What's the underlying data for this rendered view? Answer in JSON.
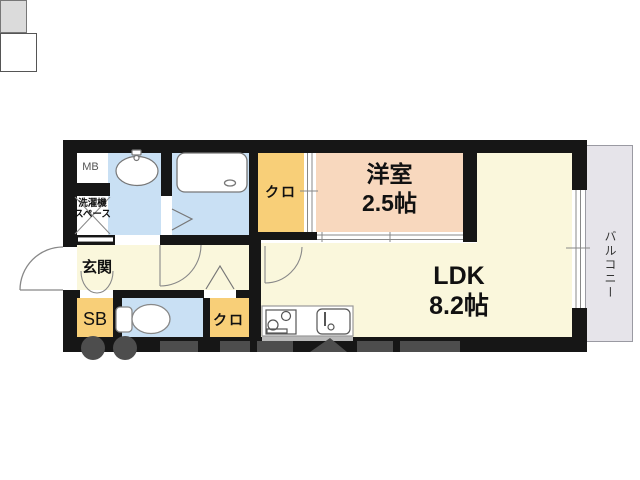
{
  "floorplan": {
    "title": "1LDK apartment floor plan",
    "rooms": {
      "meter_box": {
        "label": "MB"
      },
      "laundry_space": {
        "label_line1": "洗濯機",
        "label_line2": "スペース"
      },
      "entrance": {
        "label": "玄関"
      },
      "shoe_box": {
        "label": "SB"
      },
      "closet_upper": {
        "label": "クロ"
      },
      "closet_lower": {
        "label": "クロ"
      },
      "western_room": {
        "name": "洋室",
        "size": "2.5帖"
      },
      "ldk": {
        "name": "LDK",
        "size": "8.2帖"
      },
      "balcony": {
        "label": "バルコニー"
      }
    },
    "fixtures": [
      "bathtub",
      "washbasin",
      "toilet",
      "gas-stove",
      "kitchen-sink",
      "entrance-door",
      "room-doors",
      "sliding-doors",
      "balcony-window"
    ]
  },
  "colors": {
    "wall": "#161616",
    "cream": "#FAF7DC",
    "peach": "#F8D8BE",
    "orange": "#F8CF78",
    "blue": "#C9E0F4",
    "balcony": "#E6E4EA",
    "mb": "#DBDBDB",
    "stroke": "#777777",
    "watermark": "#4d4d4d"
  }
}
